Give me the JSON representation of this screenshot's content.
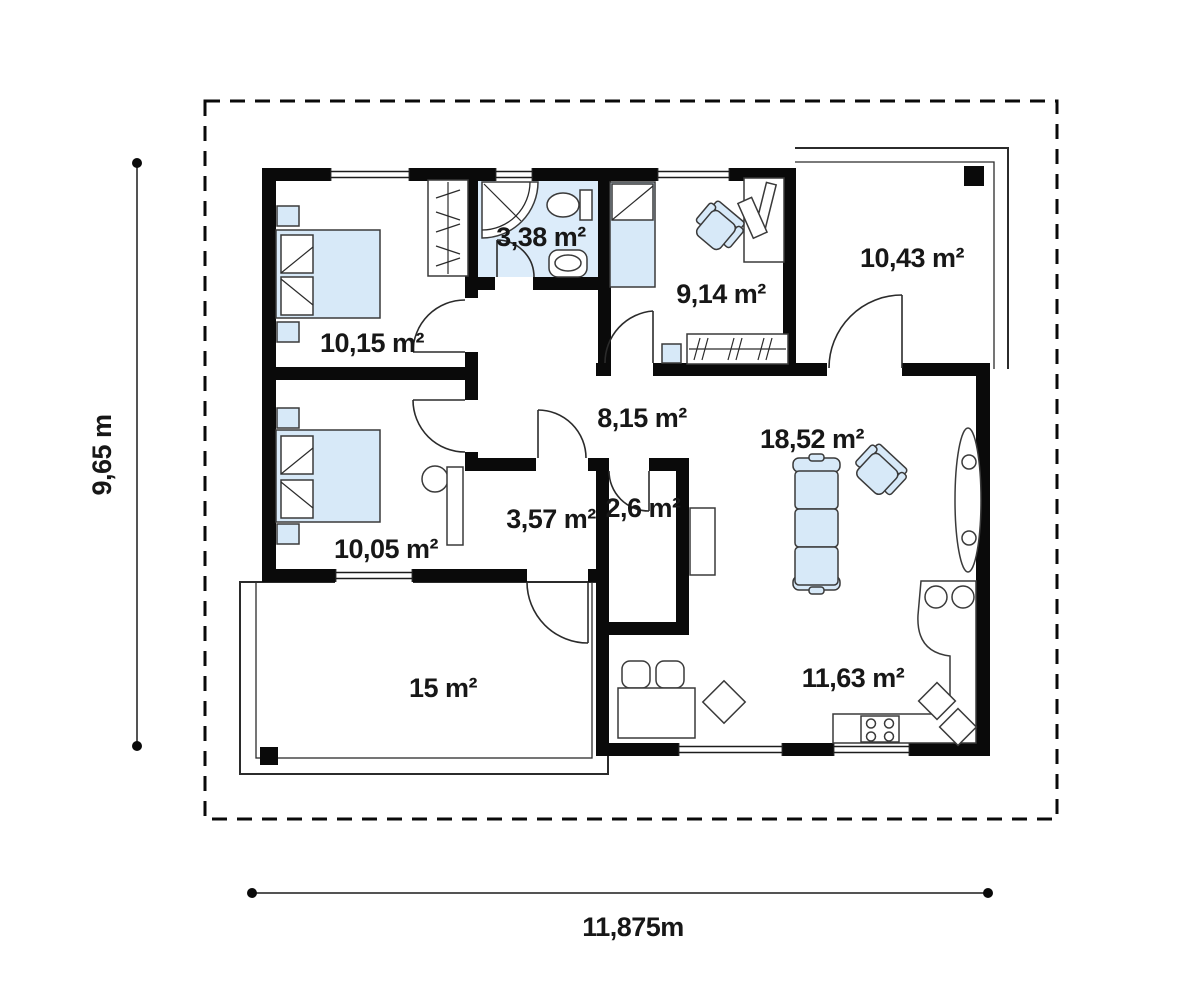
{
  "plan": {
    "title": "single-storey house floor plan",
    "rooms": [
      {
        "id": "bedroom-1",
        "area": "10,15 m²"
      },
      {
        "id": "bathroom",
        "area": "3,38 m²"
      },
      {
        "id": "office",
        "area": "9,14 m²"
      },
      {
        "id": "garage",
        "area": "10,43 m²"
      },
      {
        "id": "hall",
        "area": "8,15 m²"
      },
      {
        "id": "living-room",
        "area": "18,52 m²"
      },
      {
        "id": "bedroom-2",
        "area": "10,05 m²"
      },
      {
        "id": "vestibule",
        "area": "3,57 m²"
      },
      {
        "id": "storage",
        "area": "2,6 m²"
      },
      {
        "id": "terrace",
        "area": "15 m²"
      },
      {
        "id": "kitchen",
        "area": "11,63 m²"
      }
    ],
    "dimensions": {
      "height_label": "9,65 m",
      "width_label": "11,875m"
    },
    "colors": {
      "wall": "#0a0a0a",
      "furniture_fill": "#d7e9f8",
      "bathroom_floor": "#dcecfa",
      "outline": "#3a3a3a",
      "text": "#171717",
      "background": "#ffffff"
    }
  }
}
